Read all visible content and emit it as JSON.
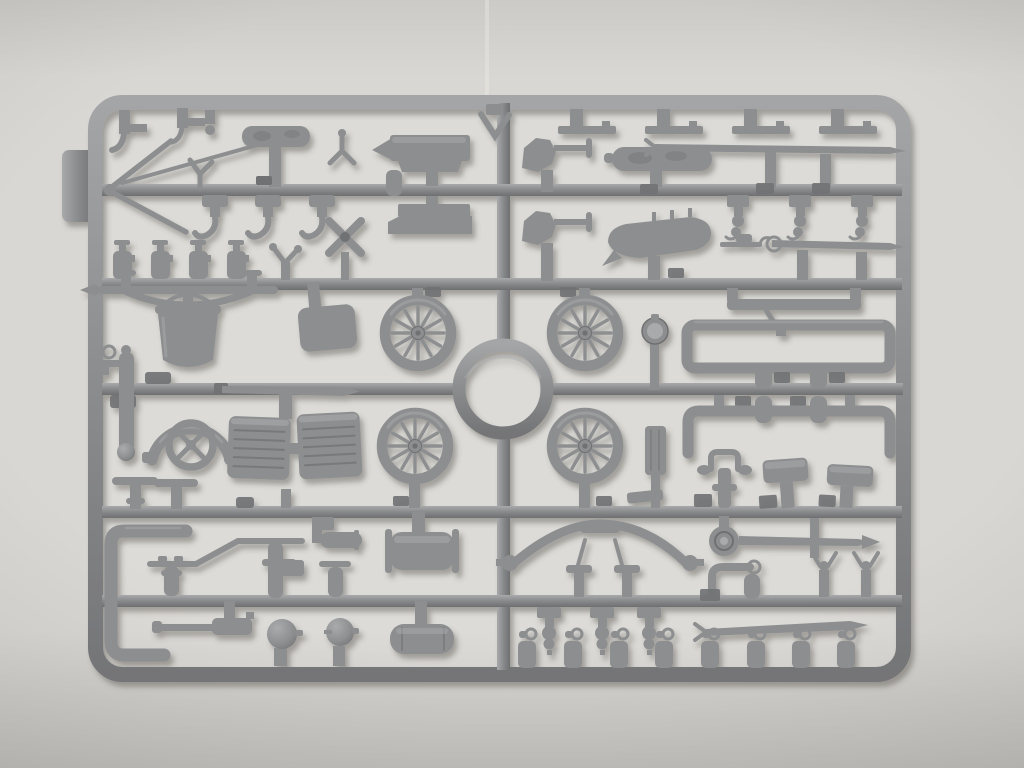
{
  "scene": {
    "type": "photograph",
    "subject": "gray injection-molded model-kit sprue (parts tree) photographed top-down on a light gray surface",
    "visible_text": "none"
  },
  "palette": {
    "bg-center": "#d9d7d3",
    "bg-mid": "#c7c5c1",
    "bg-edge": "#a7a5a3",
    "plastic": "#8d8e90",
    "plastic-light": "#a9aaac",
    "plastic-dark": "#707173",
    "shadow": "#4a463f"
  },
  "inventory": {
    "spoked_wheels": 4,
    "spokes_per_wheel": 12,
    "central_carry_ring": 1,
    "shovels": 2,
    "anvil_shaped_blocks": 2,
    "bucket": 1,
    "leaf_spring_axle": 1,
    "radiator_core_blocks": 2,
    "four_spoke_hand_wheel": 1,
    "curved_mudguard": 1,
    "mudguard_panel": 1,
    "headlamp": 1,
    "bulb_horns": 2,
    "horizontal_tank_cylinders": 3,
    "ribbed_cylinder": 1,
    "rolled_tarpaulins": 2,
    "flat_leaf_bars_top_row": 4,
    "long_rods": 4,
    "tapered_pole": 1,
    "crank_handle_with_disc": 1,
    "curved_front_axle": 1,
    "rectangular_chassis_frame": 1,
    "u_shaped_chassis_bracket": 1,
    "tow_bracket": 1,
    "boat_shaped_seat": 1,
    "x_shaped_brace": 1,
    "bow_shaped_rod": 1,
    "c_shaped_tube": 1,
    "z_bent_rod": 1,
    "t_handle_valves": 2,
    "standing_bottle_fittings": 6,
    "hanging_shackle_fittings": 6,
    "capped_cylinders_bottom_row": 8
  }
}
